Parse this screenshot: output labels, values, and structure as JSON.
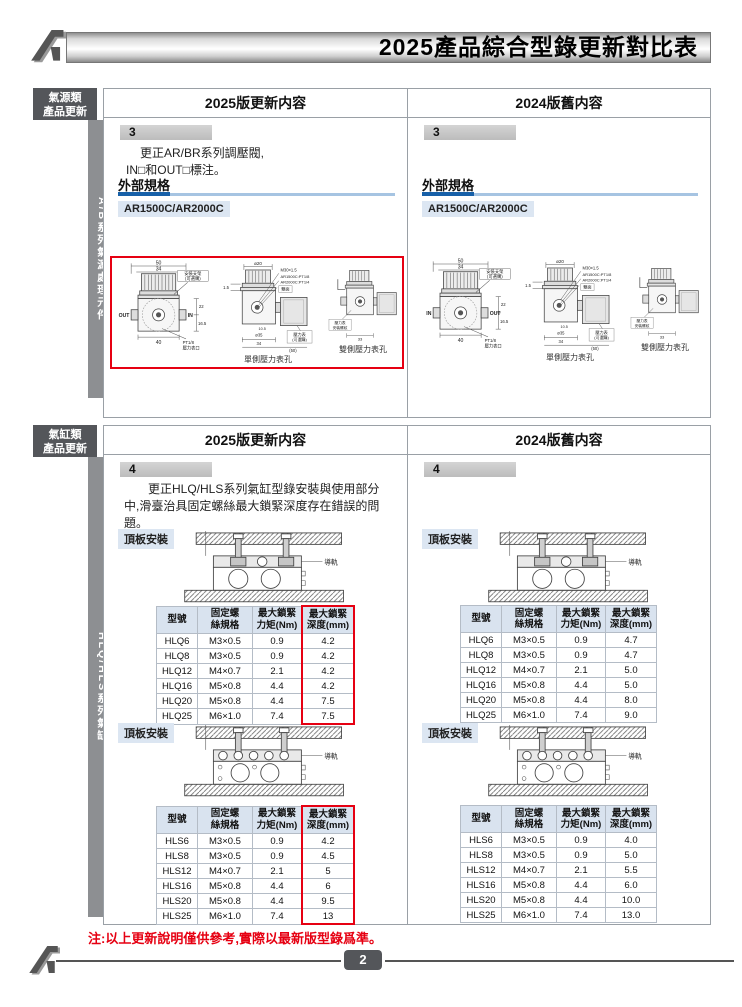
{
  "header": {
    "title": "2025產品綜合型錄更新對比表"
  },
  "columns": {
    "new_label": "2025版更新内容",
    "old_label": "2024版舊内容"
  },
  "s1": {
    "cat1": "氣源類",
    "cat2": "產品更新",
    "side_label": "A/B系列氣源處理元件",
    "item_no": "3",
    "desc1": "更正AR/BR系列調壓閥,",
    "desc2": "IN□和OUT□標注。",
    "spec_heading": "外部規格",
    "model": "AR1500C/AR2000C",
    "front": {
      "dim_top": "50",
      "dim_top2": "34",
      "bracket1": "安裝支架",
      "bracket2": "(可選購)",
      "dim_r1": "22",
      "dim_r2": "16.5",
      "dim_bottom": "40",
      "port1": "PT1/8",
      "port2": "壓力表口"
    },
    "front_new": {
      "left": "OUT",
      "right": "IN"
    },
    "front_old": {
      "left": "IN",
      "right": "OUT"
    },
    "side": {
      "dim_top": "ø20",
      "t1": "M30×1.5",
      "t2": "AR1500C:PT1/8",
      "t3": "AR2000C:PT1/4",
      "t4": "雙面",
      "dim_left": "1.5",
      "d1": "10.5",
      "d2": "ø35",
      "d3": "34",
      "d4": "(50)",
      "g1": "壓力表",
      "g2": "(可選購)",
      "caption": "單側壓力表孔"
    },
    "dual": {
      "g1": "壓力表",
      "g2": "安裝螺紋",
      "dim": "33",
      "caption": "雙側壓力表孔"
    }
  },
  "s2": {
    "cat1": "氣缸類",
    "cat2": "產品更新",
    "side_label": "HLQ/HLS系列氣缸",
    "item_no": "4",
    "desc": "更正HLQ/HLS系列氣缸型錄安裝與使用部分中,滑臺治具固定螺絲最大鎖緊深度存在錯誤的問題。",
    "mount_label": "頂板安裝",
    "rail_label": "導軌",
    "headers": [
      "型號",
      "固定螺\n絲規格",
      "最大鎖緊\n力矩(Nm)",
      "最大鎖緊\n深度(mm)"
    ],
    "hlq_new": [
      [
        "HLQ6",
        "M3×0.5",
        "0.9",
        "4.2"
      ],
      [
        "HLQ8",
        "M3×0.5",
        "0.9",
        "4.2"
      ],
      [
        "HLQ12",
        "M4×0.7",
        "2.1",
        "4.2"
      ],
      [
        "HLQ16",
        "M5×0.8",
        "4.4",
        "4.2"
      ],
      [
        "HLQ20",
        "M5×0.8",
        "4.4",
        "7.5"
      ],
      [
        "HLQ25",
        "M6×1.0",
        "7.4",
        "7.5"
      ]
    ],
    "hlq_old": [
      [
        "HLQ6",
        "M3×0.5",
        "0.9",
        "4.7"
      ],
      [
        "HLQ8",
        "M3×0.5",
        "0.9",
        "4.7"
      ],
      [
        "HLQ12",
        "M4×0.7",
        "2.1",
        "5.0"
      ],
      [
        "HLQ16",
        "M5×0.8",
        "4.4",
        "5.0"
      ],
      [
        "HLQ20",
        "M5×0.8",
        "4.4",
        "8.0"
      ],
      [
        "HLQ25",
        "M6×1.0",
        "7.4",
        "9.0"
      ]
    ],
    "hls_new": [
      [
        "HLS6",
        "M3×0.5",
        "0.9",
        "4.2"
      ],
      [
        "HLS8",
        "M3×0.5",
        "0.9",
        "4.5"
      ],
      [
        "HLS12",
        "M4×0.7",
        "2.1",
        "5"
      ],
      [
        "HLS16",
        "M5×0.8",
        "4.4",
        "6"
      ],
      [
        "HLS20",
        "M5×0.8",
        "4.4",
        "9.5"
      ],
      [
        "HLS25",
        "M6×1.0",
        "7.4",
        "13"
      ]
    ],
    "hls_old": [
      [
        "HLS6",
        "M3×0.5",
        "0.9",
        "4.0"
      ],
      [
        "HLS8",
        "M3×0.5",
        "0.9",
        "5.0"
      ],
      [
        "HLS12",
        "M4×0.7",
        "2.1",
        "5.5"
      ],
      [
        "HLS16",
        "M5×0.8",
        "4.4",
        "6.0"
      ],
      [
        "HLS20",
        "M5×0.8",
        "4.4",
        "10.0"
      ],
      [
        "HLS25",
        "M6×1.0",
        "7.4",
        "13.0"
      ]
    ]
  },
  "footer": {
    "note": "注:以上更新說明僅供參考,實際以最新版型錄爲準。",
    "page_number": "2"
  },
  "colors": {
    "accent_red": "#e60012",
    "accent_blue": "#1760a8",
    "chip_bg": "#dce6f2",
    "dark_gray": "#54565a"
  }
}
